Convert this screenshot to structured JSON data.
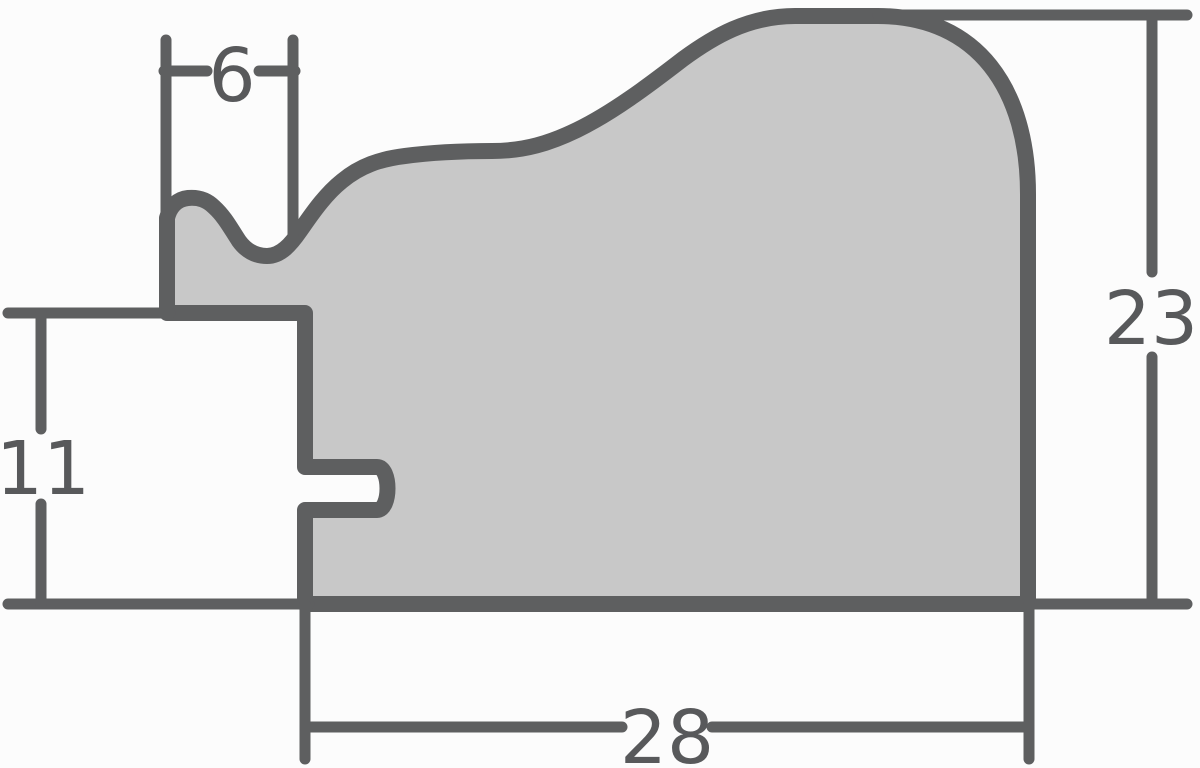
{
  "diagram": {
    "type": "technical-drawing",
    "subject": "frame-moulding-profile-cross-section",
    "dimensions": {
      "lip_width": {
        "label": "6",
        "value": 6
      },
      "rabbet_height": {
        "label": "11",
        "value": 11
      },
      "overall_height": {
        "label": "23",
        "value": 23
      },
      "overall_width": {
        "label": "28",
        "value": 28
      }
    },
    "colors": {
      "outline": "#5e5f60",
      "fill": "#c8c8c8",
      "text": "#58595b",
      "background": "#fcfcfc"
    }
  }
}
